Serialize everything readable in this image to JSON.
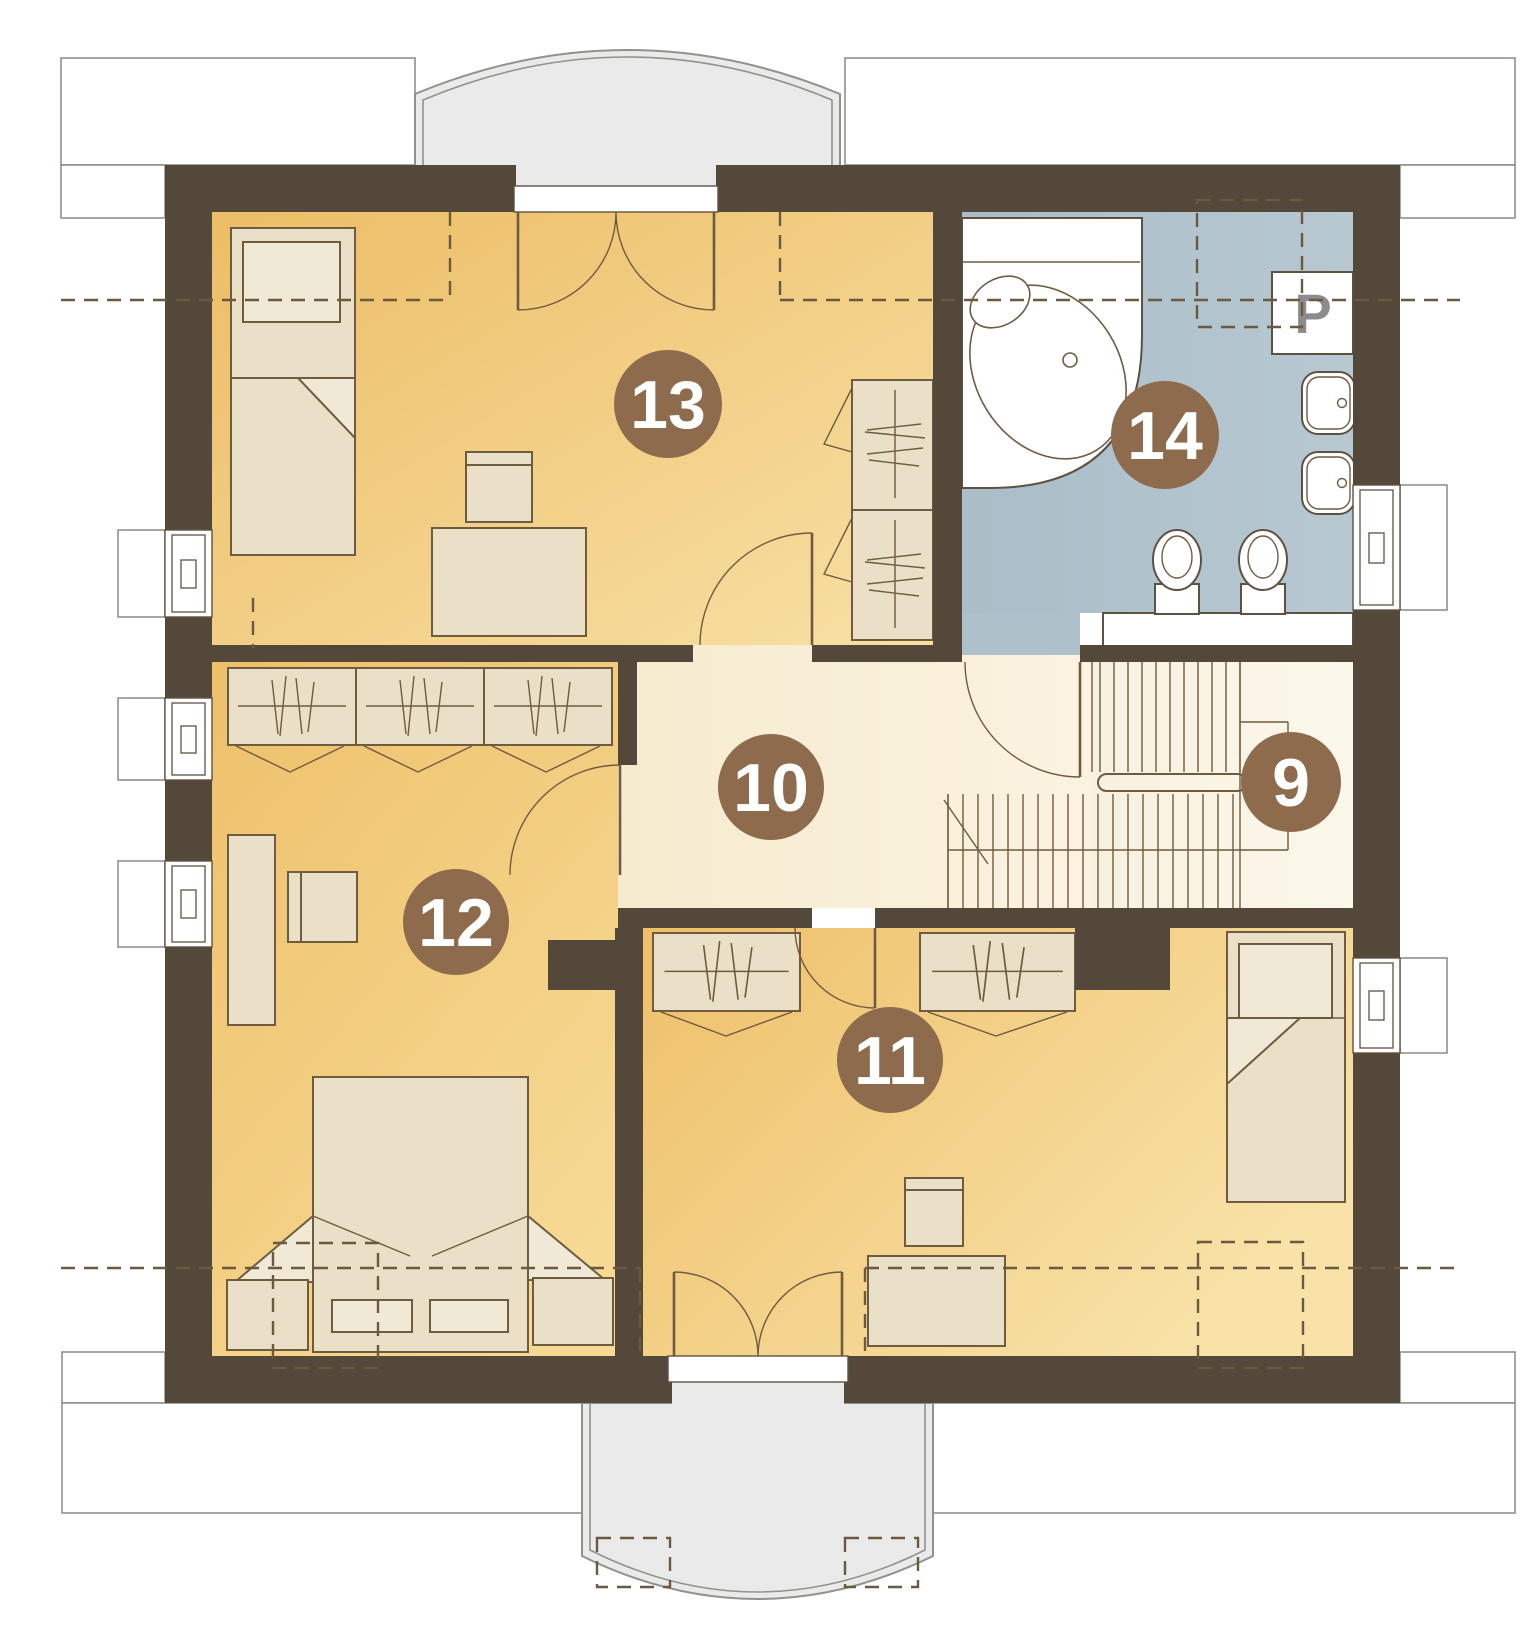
{
  "plan": {
    "kind": "attic-floor-plan",
    "rooms": [
      {
        "number": "9",
        "name": "staircase"
      },
      {
        "number": "10",
        "name": "hallway"
      },
      {
        "number": "11",
        "name": "bedroom-right"
      },
      {
        "number": "12",
        "name": "bedroom-left"
      },
      {
        "number": "13",
        "name": "bedroom-top"
      },
      {
        "number": "14",
        "name": "bathroom"
      }
    ],
    "labels": {
      "washer": "P"
    },
    "colors": {
      "wall": "#54483a",
      "room_floor_dark": "#ecbd66",
      "room_floor_light": "#f8e2a8",
      "hallway_floor": "#f7ecd2",
      "stairs_floor": "#faf5e8",
      "bathroom_floor": "#aec0ca",
      "furniture": "#e9e0c7",
      "furniture_line": "#6f5b3f",
      "room_badge": "#8d6b4c",
      "balcony": "#e9eae9"
    }
  }
}
